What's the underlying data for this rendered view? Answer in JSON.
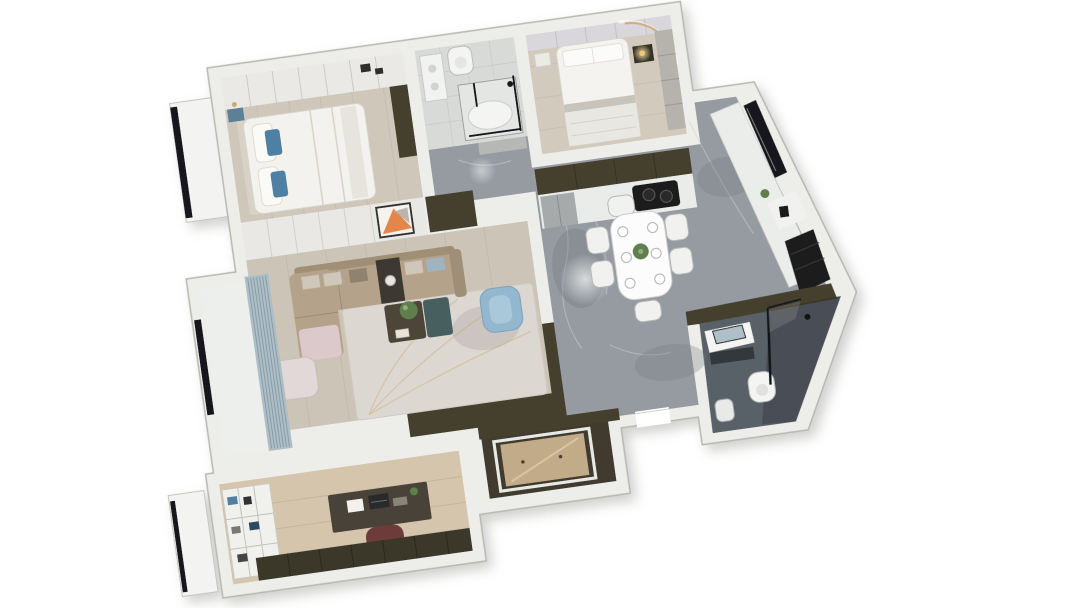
{
  "scene": {
    "type": "apartment-3d-floor-plan-render",
    "view": "axonometric-top-down",
    "rotation_deg": -8,
    "background": "#ffffff"
  },
  "palette": {
    "wall": "#edeeea",
    "wallEdge": "#b8b7b1",
    "marble": "#969ba1",
    "marbleVein": "#ced2d5",
    "bathDark": "#596067",
    "floorBedroom": "#cfc8ba",
    "floorBedroom2": "#d2cbbd",
    "floorLiving": "#ccc5b7",
    "floorWood": "#d5c5ac",
    "tileLight": "#d8dad7",
    "olive": "#45412f",
    "woodCabinet": "#c2ab89",
    "sofa": "#b4a38a",
    "sofaDark": "#a08f77",
    "pillowBlue": "#4e80a2",
    "chairBlue": "#92b7cf",
    "teal": "#47615f",
    "walnut": "#4e4539",
    "plant": "#5f7f4d",
    "orange": "#e2874a",
    "curtain": "#aebec6",
    "curtainStripe": "#7e949f",
    "chairRed": "#6e3a3a",
    "gold": "#c9a96e",
    "glassDark": "#17191b",
    "fixtureWhite": "#f4f5f3",
    "fridgeGray": "#a6aaab",
    "panelLavender": "#d9d7dc",
    "panelWhite": "#ebe9e5"
  },
  "rooms": [
    {
      "id": "master-bedroom",
      "position": "top-left",
      "floor": "light-wood",
      "furniture": [
        "wardrobe-row",
        "double-bed",
        "white-duvet",
        "blue-pillows",
        "teal-nightstand",
        "wall-lamp",
        "tall-dark-cabinet",
        "bay-window"
      ]
    },
    {
      "id": "bathroom-1",
      "position": "top-middle",
      "floor": "light-tile",
      "furniture": [
        "vanity",
        "toilet",
        "shower-tub",
        "black-shower-frame",
        "sliding-door"
      ]
    },
    {
      "id": "bedroom-2",
      "position": "top-right",
      "floor": "light-wood",
      "furniture": [
        "double-bed",
        "white-pillows",
        "dark-nightstand",
        "glowing-table-lamp",
        "white-nightstand",
        "wardrobe-panel",
        "gold-arc-cove-light"
      ]
    },
    {
      "id": "kitchen",
      "position": "right",
      "floor": "gray-marble",
      "furniture": [
        "olive-upper-cabinets",
        "white-counter",
        "black-cooktop",
        "gray-fridge",
        "right-counter",
        "black-window",
        "shelf-niche",
        "coffee-maker",
        "tall-black-cabinet",
        "plant"
      ]
    },
    {
      "id": "dining-area",
      "position": "right-center",
      "floor": "gray-marble",
      "furniture": [
        "white-dining-table",
        "six-chairs",
        "place-settings",
        "centerpiece-plant",
        "ceiling-light-glow"
      ]
    },
    {
      "id": "hallway",
      "position": "center",
      "floor": "gray-marble",
      "furniture": []
    },
    {
      "id": "entry",
      "position": "bottom-center-right",
      "floor": "gray-marble",
      "furniture": [
        "entry-door-opening"
      ]
    },
    {
      "id": "bathroom-2",
      "position": "bottom-right",
      "floor": "dark-tile",
      "furniture": [
        "vanity",
        "leaning-mirror",
        "toilet",
        "glass-shower-partition",
        "shower-head"
      ]
    },
    {
      "id": "living-room",
      "position": "center-left",
      "floor": "light-wood",
      "furniture": [
        "tv-wardrobe-panels",
        "orange-artwork",
        "sectional-sofa",
        "chaise",
        "throw-pillows",
        "side-insert-table",
        "pink-lounge",
        "coffee-table-walnut-teal",
        "potted-plant",
        "blue-armchair",
        "area-rug",
        "balcony",
        "striped-curtains",
        "black-window"
      ]
    },
    {
      "id": "study",
      "position": "bottom-left",
      "floor": "wood",
      "furniture": [
        "bookshelf",
        "desk",
        "laptop",
        "dark-red-office-chair",
        "dark-wardrobe-row",
        "bay-window"
      ]
    },
    {
      "id": "walk-in-closet",
      "position": "bottom-center",
      "floor": "dark-olive",
      "furniture": [
        "wood-cabinet-white-frame"
      ]
    }
  ]
}
